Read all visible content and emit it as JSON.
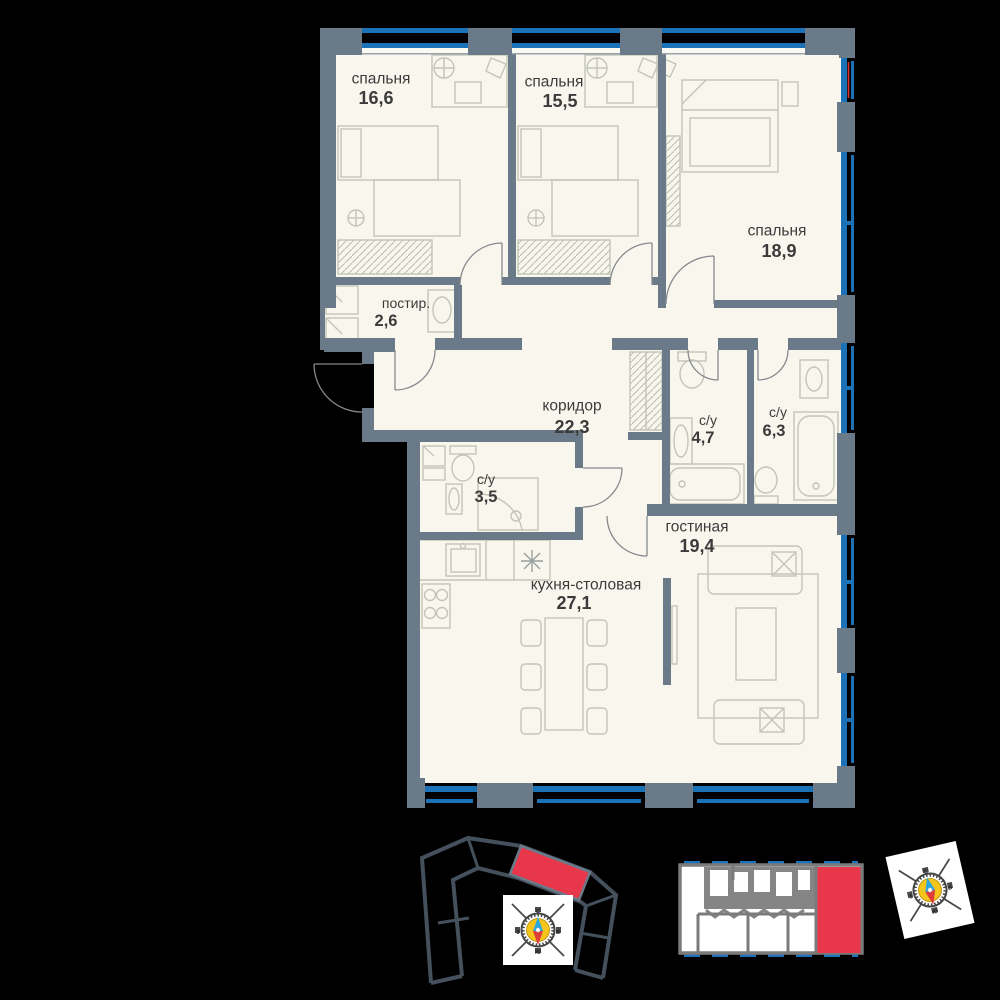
{
  "floor_plan": {
    "rooms": [
      {
        "id": "bedroom-1",
        "name": "спальня",
        "area": "16,6"
      },
      {
        "id": "bedroom-2",
        "name": "спальня",
        "area": "15,5"
      },
      {
        "id": "bedroom-3",
        "name": "спальня",
        "area": "18,9"
      },
      {
        "id": "laundry",
        "name": "постир.",
        "area": "2,6"
      },
      {
        "id": "corridor",
        "name": "коридор",
        "area": "22,3"
      },
      {
        "id": "bathroom-1",
        "name": "с/у",
        "area": "4,7"
      },
      {
        "id": "bathroom-2",
        "name": "с/у",
        "area": "6,3"
      },
      {
        "id": "bathroom-3",
        "name": "с/у",
        "area": "3,5"
      },
      {
        "id": "living-room",
        "name": "гостиная",
        "area": "19,4"
      },
      {
        "id": "kitchen-dining",
        "name": "кухня-столовая",
        "area": "27,1"
      }
    ]
  },
  "compass": {
    "north": "С",
    "south": "Ю",
    "west": "З",
    "east": "В"
  },
  "colors": {
    "wall": "#6b7a88",
    "floor": "#f9f7ed",
    "window_blue": "#1c72b7",
    "highlight_red": "#e8374a",
    "site_outline": "#44505c"
  }
}
